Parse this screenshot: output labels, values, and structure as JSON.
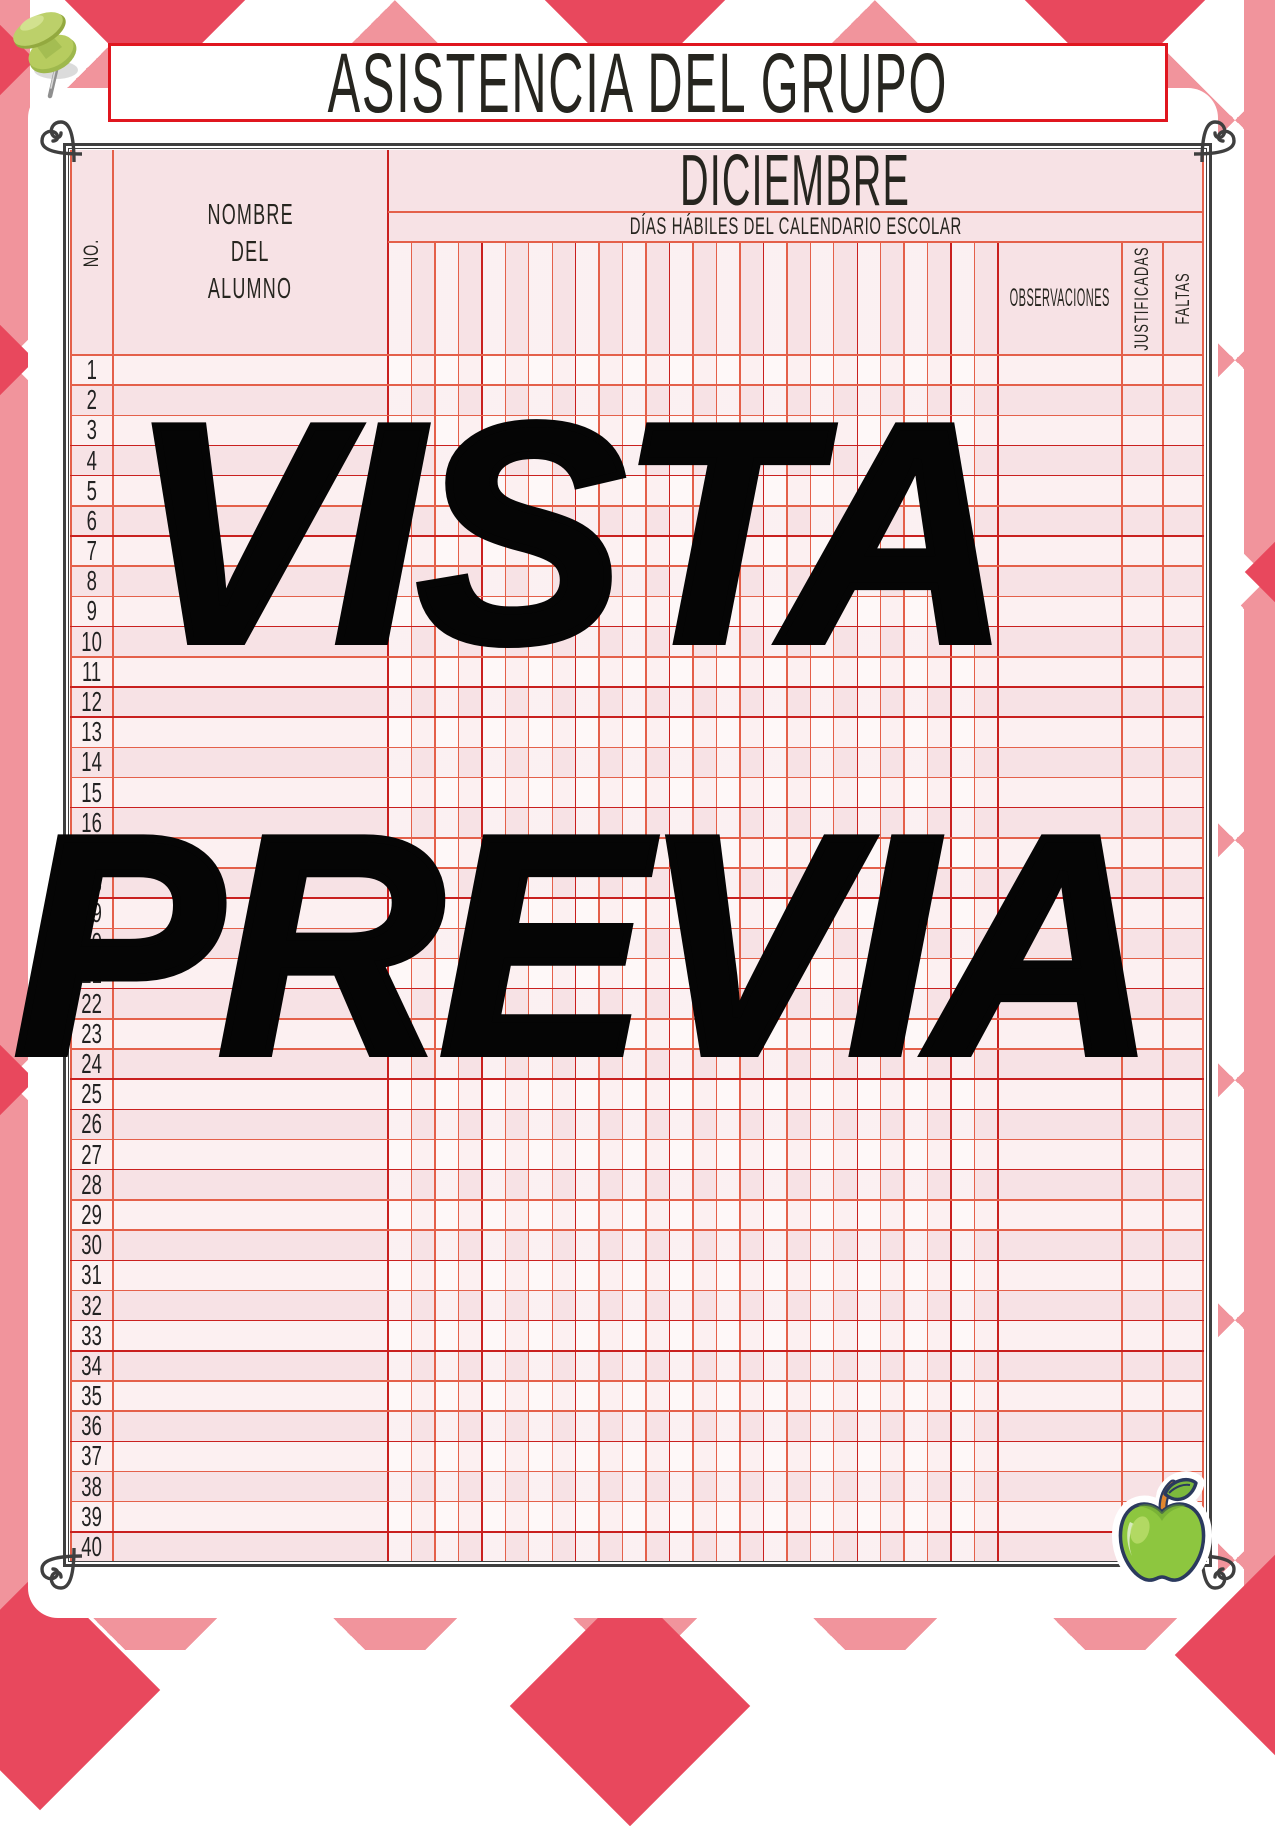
{
  "title": {
    "text": "ASISTENCIA DEL GRUPO"
  },
  "watermark": {
    "line1": "VISTA",
    "line2": "PREVIA"
  },
  "table": {
    "month": "DICIEMBRE",
    "subheader": "DÍAS HÁBILES DEL CALENDARIO ESCOLAR",
    "no_label": "NO.",
    "name_header_lines": [
      "NOMBRE",
      "DEL",
      "ALUMNO"
    ],
    "observations_label": "OBSERVACIONES",
    "justified_label": "JUSTIFICADAS",
    "absences_label": "FALTAS",
    "day_columns": 26,
    "row_numbers": [
      1,
      2,
      3,
      4,
      5,
      6,
      7,
      8,
      9,
      10,
      11,
      12,
      13,
      14,
      15,
      16,
      17,
      18,
      19,
      20,
      21,
      22,
      23,
      24,
      25,
      26,
      27,
      28,
      29,
      30,
      31,
      32,
      33,
      34,
      35,
      36,
      37,
      38,
      39,
      40
    ]
  },
  "icons": {
    "pushpin": "pushpin-icon",
    "apple": "apple-icon"
  },
  "colors": {
    "argyle_light": "#f1949c",
    "argyle_dark": "#e8485d",
    "salmon": "#e4604a",
    "crimson": "#c9201f",
    "pink_light": "#fcf0f1",
    "pink_dark": "#f7e2e5",
    "frame": "#3f3f3f",
    "title_border": "#e0161f",
    "ink": "#26251f",
    "watermark": "#050505",
    "apple_green": "#8dc63f",
    "pin_green": "#b7cc5f"
  }
}
